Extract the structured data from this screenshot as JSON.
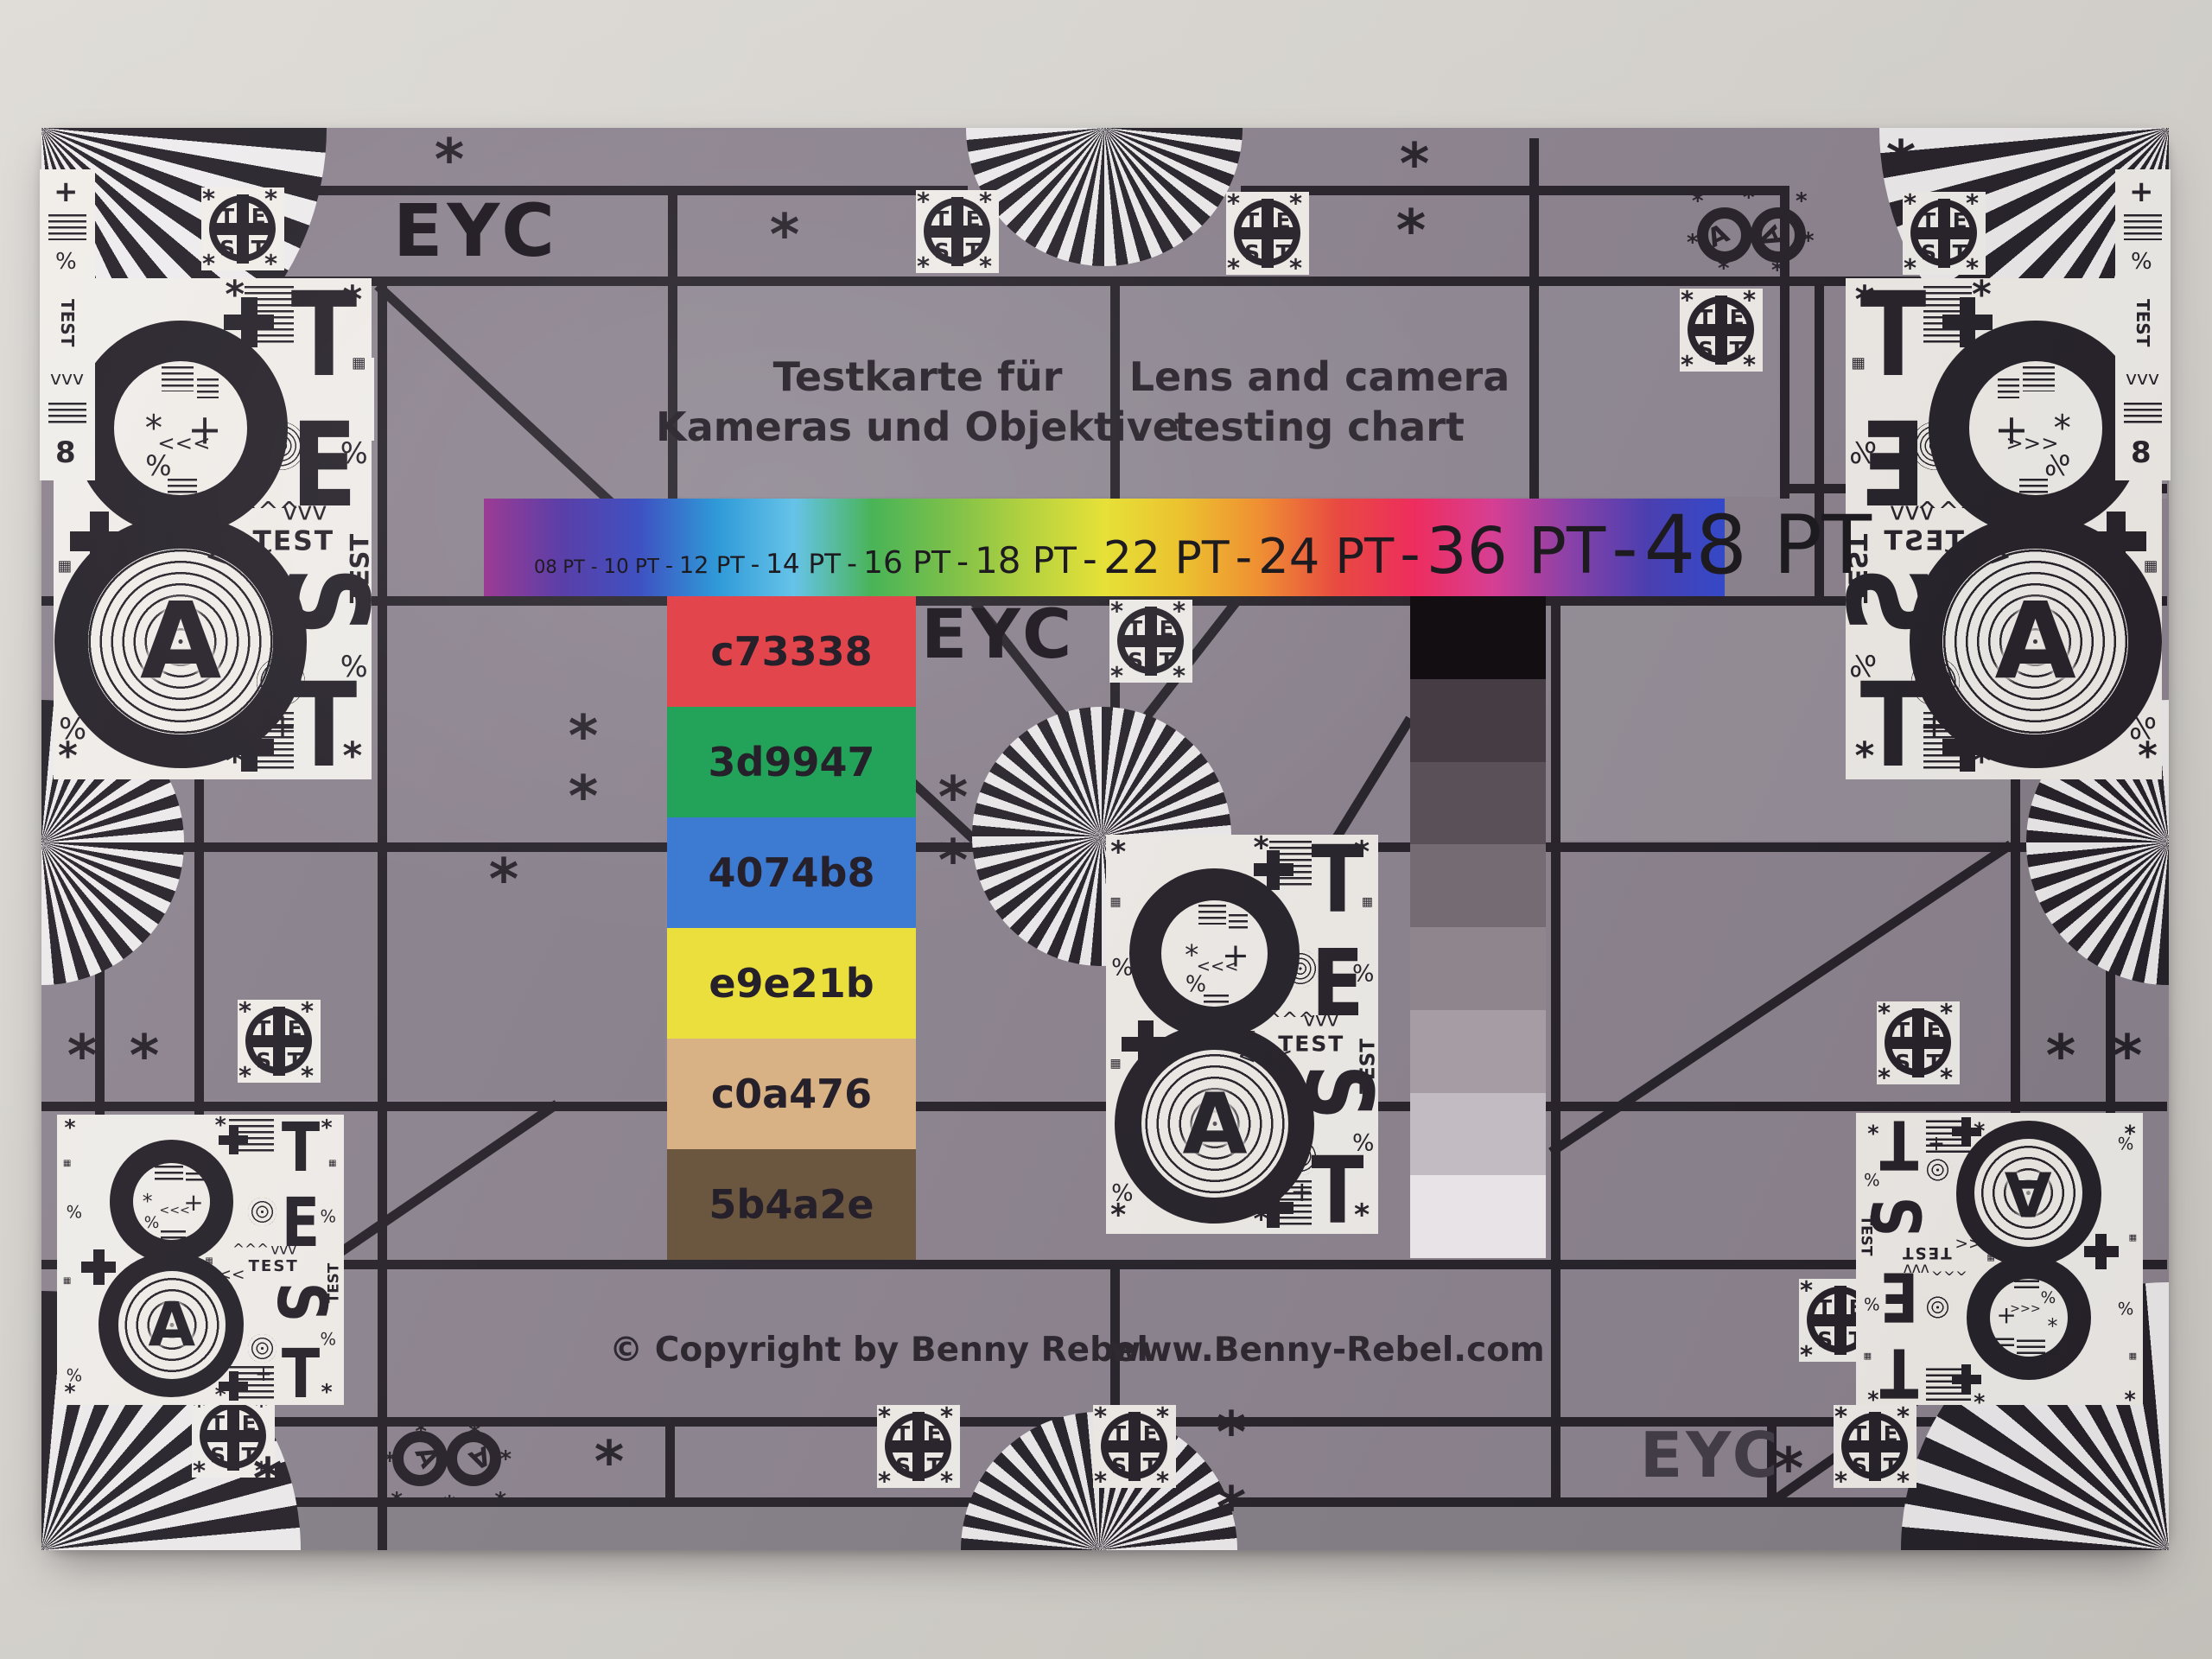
{
  "texts": {
    "eyc": "EYC",
    "title_de": "Testkarte für\nKameras und Objektive",
    "title_en": "Lens and camera\ntesting chart",
    "copyright": "© Copyright by Benny Rebel",
    "website": "www.Benny-Rebel.com"
  },
  "pt_scale": {
    "labels": [
      "08 PT",
      "10 PT",
      "12 PT",
      "14 PT",
      "16 PT",
      "18 PT",
      "22 PT",
      "24 PT",
      "36 PT",
      "48 PT"
    ],
    "separator": "-"
  },
  "rainbow_colors": [
    "#9c3b94",
    "#5a3fa8",
    "#3f51c1",
    "#2f9ad8",
    "#66c3e8",
    "#49b457",
    "#7cc04a",
    "#b5d23f",
    "#e6e138",
    "#ecc12f",
    "#ef8f33",
    "#e84a41",
    "#ee2d5e",
    "#d63f93",
    "#8a41a8",
    "#4b3fb0",
    "#3449c8"
  ],
  "color_patches": [
    {
      "label": "c73338",
      "swatch": "#e2464c"
    },
    {
      "label": "3d9947",
      "swatch": "#23a259"
    },
    {
      "label": "4074b8",
      "swatch": "#3d7ad2"
    },
    {
      "label": "e9e21b",
      "swatch": "#eadf3d"
    },
    {
      "label": "c0a476",
      "swatch": "#d8b184"
    },
    {
      "label": "5b4a2e",
      "swatch": "#6b5740"
    }
  ],
  "grayscale_steps": [
    "#120e12",
    "#463d44",
    "#5a5158",
    "#746c72",
    "#8e868c",
    "#a59da3",
    "#c2bbc1",
    "#e7e3e6"
  ],
  "test_badge": {
    "letters": [
      "T",
      "E",
      "S",
      "T"
    ],
    "corner_glyph": "*"
  },
  "eight_panel": {
    "eight": "8",
    "letter": "A",
    "test_vertical": [
      "T",
      "E",
      "S",
      "T"
    ],
    "test_word": "TEST",
    "asterisk": "*",
    "percent": "%",
    "plus": "+",
    "arrows_left": "<<<",
    "arrows_up": "^^^",
    "arrows_down": "vvv",
    "checker": "▦"
  },
  "colors": {
    "wall": "#d9d6d1",
    "chart_base": "#8d8490",
    "ink": "#27222a",
    "panel_white": "#f1eeea"
  }
}
